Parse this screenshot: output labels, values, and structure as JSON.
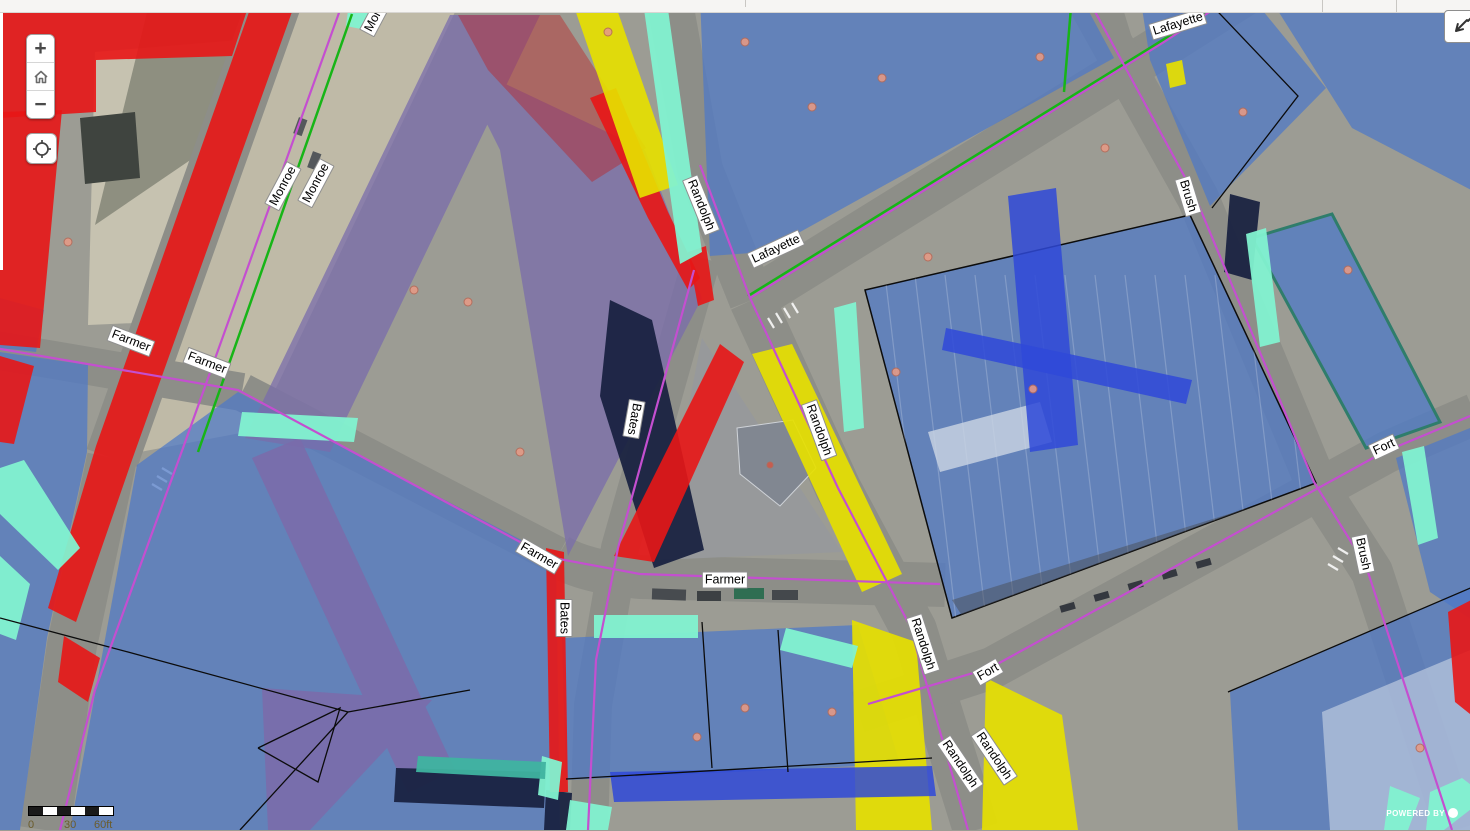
{
  "map": {
    "controls": {
      "zoom_in_label": "+",
      "zoom_out_label": "−",
      "home_icon": "home-icon",
      "locate_icon": "locate-crosshair-icon",
      "collapse_icon": "collapse-arrow-icon"
    },
    "scale_bar": {
      "tick_labels": [
        "0",
        "30",
        "60ft"
      ]
    },
    "attribution": {
      "text": "POWERED BY"
    },
    "street_labels": [
      {
        "text": "Monroe",
        "x": 283,
        "y": 186,
        "rot": -62
      },
      {
        "text": "Monroe",
        "x": 316,
        "y": 183,
        "rot": -62
      },
      {
        "text": "Monroe",
        "x": 378,
        "y": 12,
        "rot": -62
      },
      {
        "text": "Farmer",
        "x": 131,
        "y": 341,
        "rot": 21
      },
      {
        "text": "Farmer",
        "x": 207,
        "y": 363,
        "rot": 21
      },
      {
        "text": "Randolph",
        "x": 701,
        "y": 205,
        "rot": 68
      },
      {
        "text": "Lafayette",
        "x": 776,
        "y": 249,
        "rot": -25
      },
      {
        "text": "Lafayette",
        "x": 1178,
        "y": 24,
        "rot": -17
      },
      {
        "text": "Brush",
        "x": 1188,
        "y": 196,
        "rot": 73
      },
      {
        "text": "Bates",
        "x": 634,
        "y": 419,
        "rot": 100
      },
      {
        "text": "Farmer",
        "x": 539,
        "y": 556,
        "rot": 30
      },
      {
        "text": "Farmer",
        "x": 725,
        "y": 580,
        "rot": 0
      },
      {
        "text": "Bates",
        "x": 564,
        "y": 618,
        "rot": 90
      },
      {
        "text": "Randolph",
        "x": 819,
        "y": 430,
        "rot": 70
      },
      {
        "text": "Randolph",
        "x": 923,
        "y": 644,
        "rot": 72
      },
      {
        "text": "Fort",
        "x": 988,
        "y": 672,
        "rot": -30
      },
      {
        "text": "Fort",
        "x": 1384,
        "y": 447,
        "rot": -25
      },
      {
        "text": "Brush",
        "x": 1363,
        "y": 554,
        "rot": 78
      },
      {
        "text": "Randolph",
        "x": 994,
        "y": 756,
        "rot": 56
      },
      {
        "text": "Randolph",
        "x": 960,
        "y": 764,
        "rot": 56
      }
    ],
    "legend_colors": {
      "parcel_blue": "#4d79c7",
      "overlay_red": "#e81616",
      "overlay_yellow": "#e6e000",
      "overlay_cyan": "#82f2d0",
      "overlay_purple": "#7a6cab",
      "overlay_navy": "#18203f",
      "overlay_royal_blue": "#2f49d8",
      "centerline_magenta": "#c44fd0",
      "centerline_green": "#17b517"
    }
  }
}
